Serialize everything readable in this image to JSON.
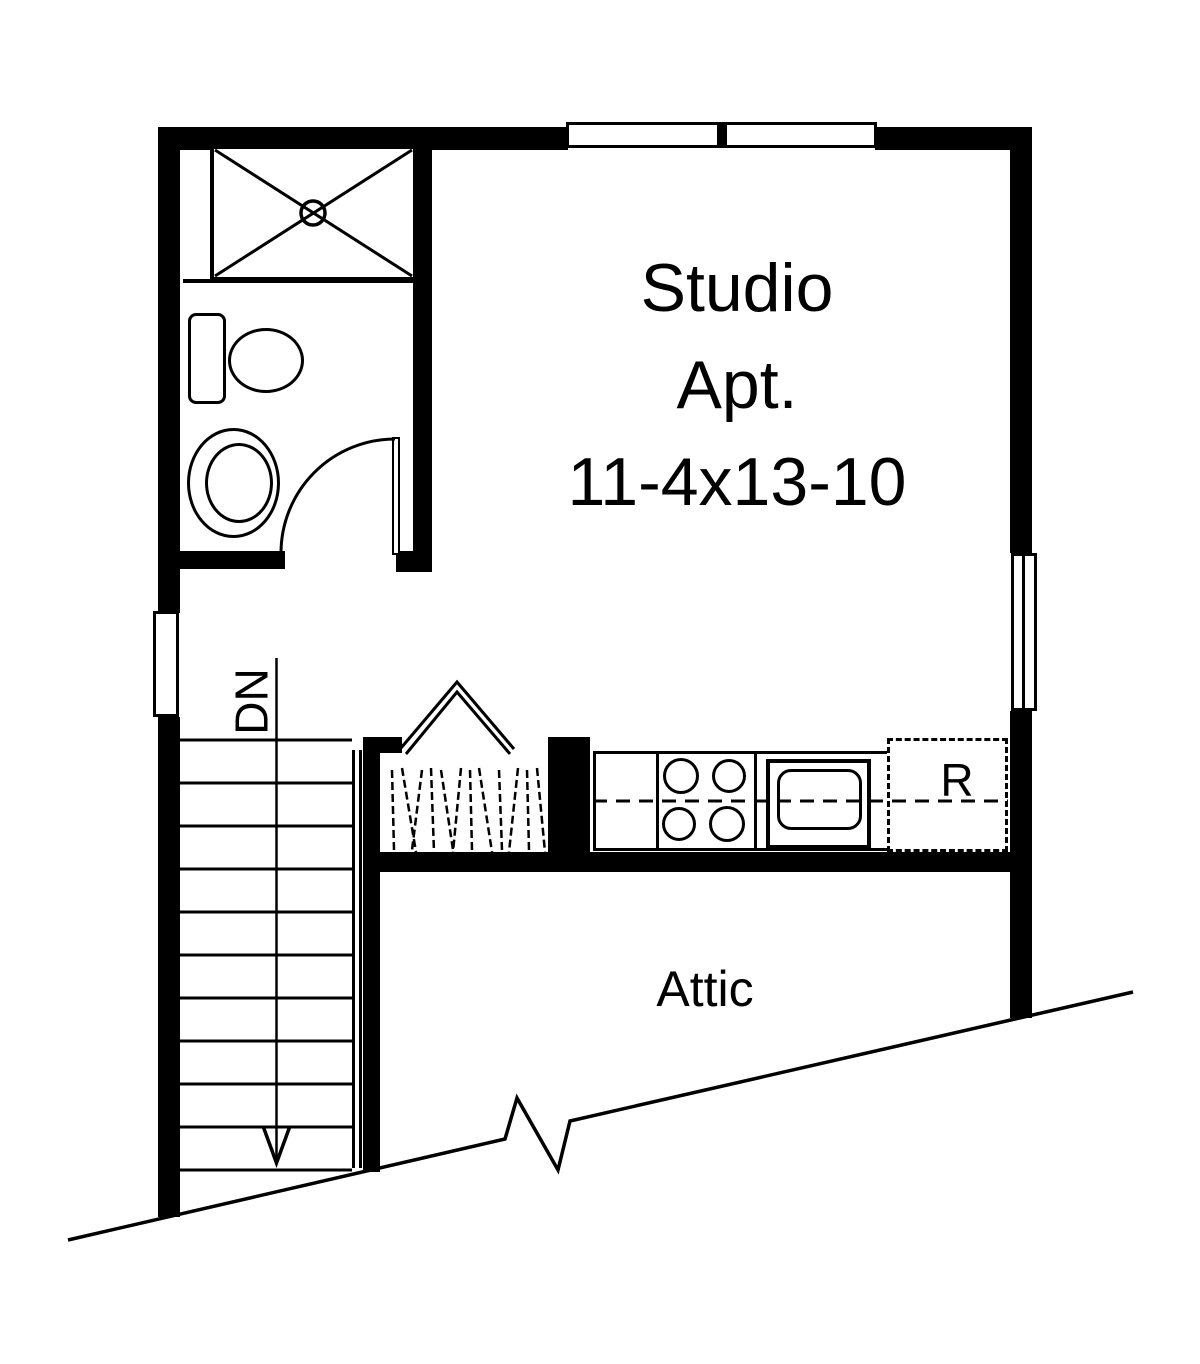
{
  "canvas": {
    "background": "#ffffff",
    "ink": "#000000"
  },
  "floorplan": {
    "room": {
      "name_line1": "Studio",
      "name_line2": "Apt.",
      "dimensions": "11-4x13-10"
    },
    "stairs": {
      "direction_label": "DN"
    },
    "kitchen": {
      "refrigerator_label": "R"
    },
    "attic": {
      "label": "Attic"
    }
  }
}
